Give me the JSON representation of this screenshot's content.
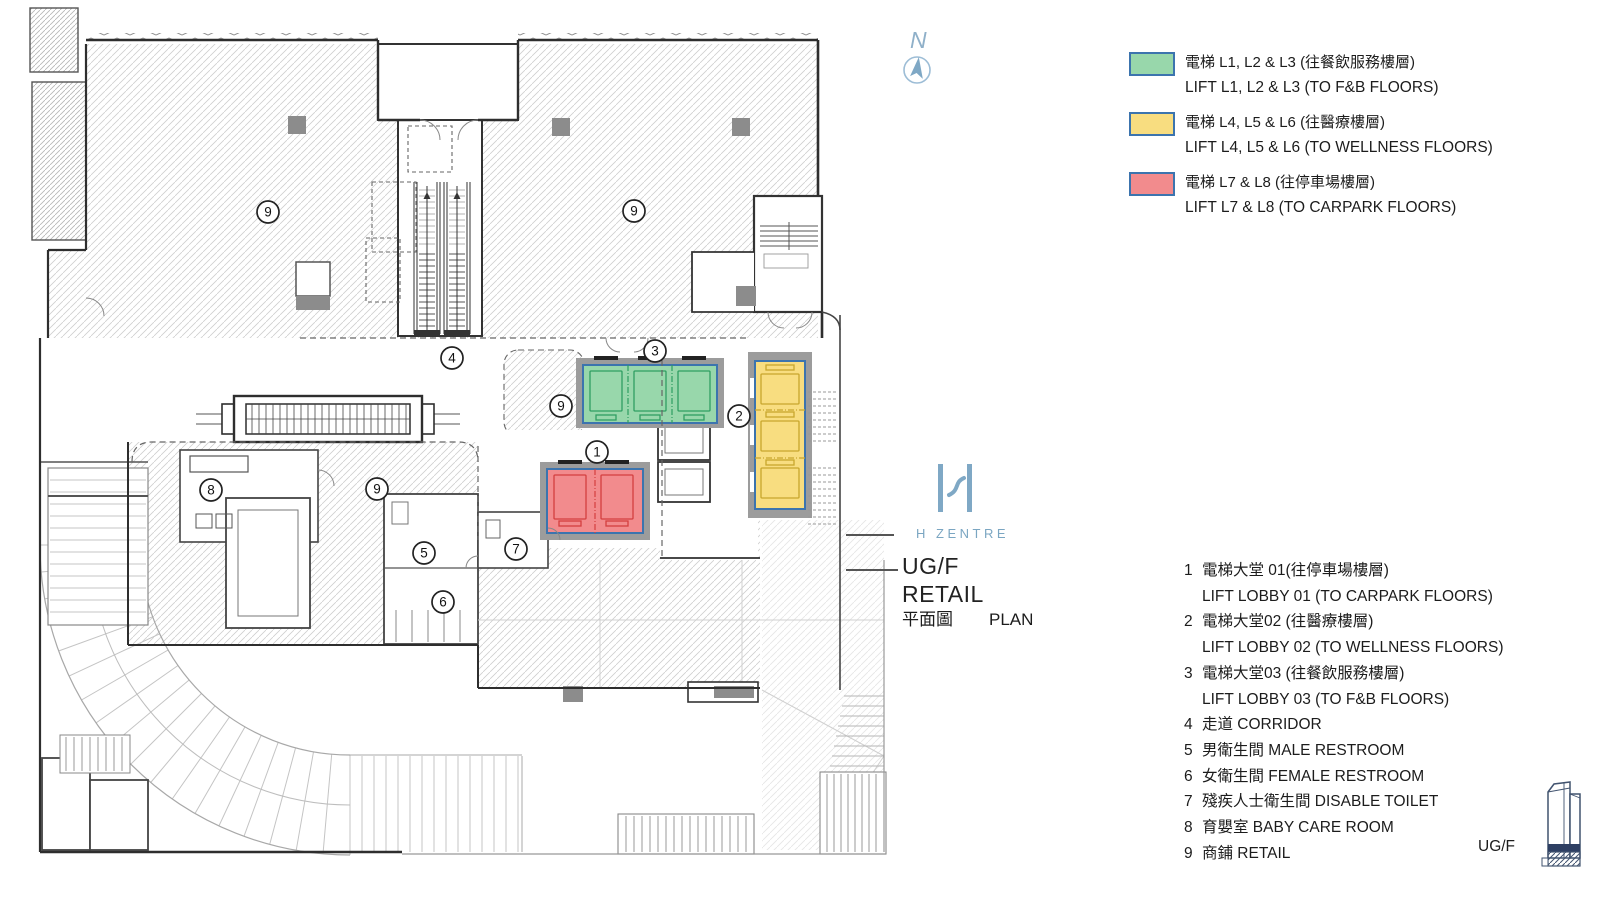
{
  "plan": {
    "north_label": "N",
    "markers": [
      {
        "label": "9"
      },
      {
        "label": "9"
      },
      {
        "label": "4"
      },
      {
        "label": "3"
      },
      {
        "label": "9"
      },
      {
        "label": "2"
      },
      {
        "label": "1"
      },
      {
        "label": "8"
      },
      {
        "label": "9"
      },
      {
        "label": "5"
      },
      {
        "label": "7"
      },
      {
        "label": "6"
      }
    ]
  },
  "branding": {
    "logo_text": "H ZENTRE"
  },
  "title_block": {
    "floor": "UG/F",
    "use": "RETAIL",
    "plan_zh": "平面圖",
    "plan_en": "PLAN"
  },
  "legend": {
    "items": [
      {
        "color": "#98d7ab",
        "zh": "電梯 L1, L2 & L3 (往餐飲服務樓層)",
        "en": "LIFT L1, L2 & L3 (TO F&B FLOORS)"
      },
      {
        "color": "#f8dd80",
        "zh": "電梯 L4, L5 & L6 (往醫療樓層)",
        "en": "LIFT L4, L5 & L6 (TO WELLNESS FLOORS)"
      },
      {
        "color": "#f28b8d",
        "zh": "電梯 L7 & L8 (往停車場樓層)",
        "en": "LIFT L7 & L8 (TO CARPARK FLOORS)"
      }
    ]
  },
  "key_list": {
    "rows": [
      {
        "num": "1",
        "text": "電梯大堂 01(往停車場樓層)"
      },
      {
        "num": "",
        "text": "LIFT LOBBY 01  (TO CARPARK FLOORS)"
      },
      {
        "num": "2",
        "text": "電梯大堂02 (往醫療樓層)"
      },
      {
        "num": "",
        "text": "LIFT LOBBY 02 (TO WELLNESS FLOORS)"
      },
      {
        "num": "3",
        "text": "電梯大堂03 (往餐飲服務樓層)"
      },
      {
        "num": "",
        "text": "LIFT LOBBY 03 (TO F&B FLOORS)"
      },
      {
        "num": "4",
        "text": "走道 CORRIDOR"
      },
      {
        "num": "5",
        "text": "男衛生間 MALE RESTROOM"
      },
      {
        "num": "6",
        "text": "女衛生間 FEMALE RESTROOM"
      },
      {
        "num": "7",
        "text": "殘疾人士衛生間 DISABLE TOILET"
      },
      {
        "num": "8",
        "text": "育嬰室 BABY CARE ROOM"
      },
      {
        "num": "9",
        "text": "商鋪 RETAIL"
      }
    ]
  },
  "floor_tag": {
    "label": "UG/F"
  },
  "colors": {
    "lift_green": "#98d7ab",
    "lift_yellow": "#f8dd80",
    "lift_red": "#f28b8d",
    "accent_blue": "#7ba6c2"
  }
}
